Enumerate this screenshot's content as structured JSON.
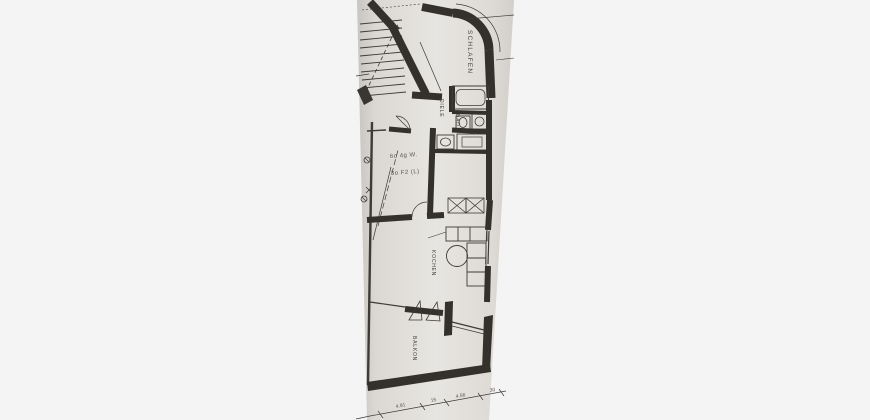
{
  "page": {
    "background_color": "#f5f4f4"
  },
  "photo": {
    "description": "scanned architectural floor plan photo, rotated 90 degrees",
    "paper_color": "#dcd9d4",
    "ink_color": "#39352f"
  },
  "plan": {
    "labels": {
      "schlafen": "SCHLAFEN",
      "diele": "DIELE",
      "bad": "BAD",
      "kochen": "KOCHEN",
      "balkon": "BALKON"
    },
    "annotations": {
      "0": "6o 4g W.",
      "1": "3o F2 (L)"
    },
    "dimensions": {
      "0": "4.91",
      "1": "15",
      "2": "4.56",
      "3": "30"
    }
  }
}
